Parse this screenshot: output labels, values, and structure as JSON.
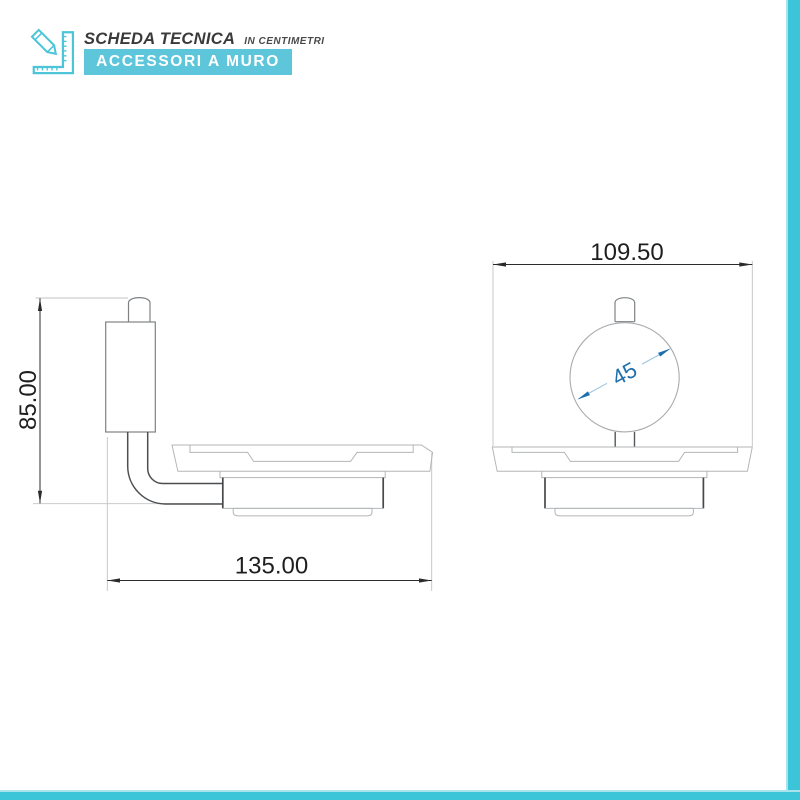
{
  "header": {
    "icon": "pencil-ruler-icon",
    "title": "SCHEDA TECNICA",
    "subtitle": "IN CENTIMETRI",
    "banner": "ACCESSORI A MURO"
  },
  "drawing": {
    "side_view": {
      "height_label": "85.00",
      "width_label": "135.00"
    },
    "front_view": {
      "width_label": "109.50",
      "diameter_label": "45"
    }
  },
  "colors": {
    "accent_banner": "#5EC6DA",
    "accent_stripe": "#3CC4D8",
    "dimension_text": "#1F1F1F",
    "dimension_blue": "#1E6FAD",
    "outline_light": "#B3B6B8",
    "outline_dark": "#4B4E50"
  }
}
